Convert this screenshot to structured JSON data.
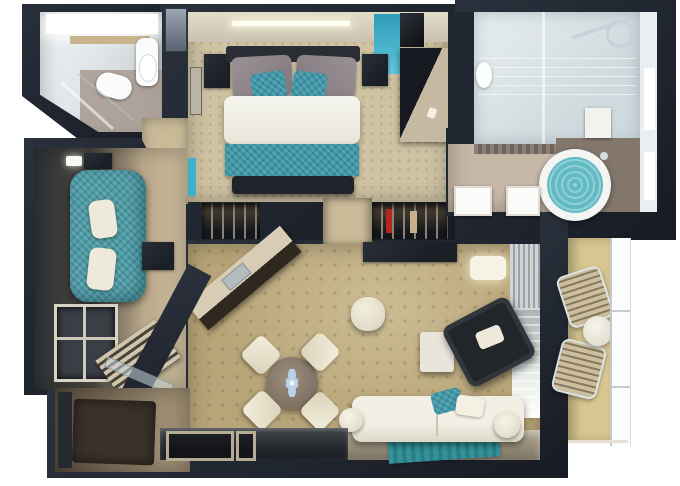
{
  "scene": {
    "type": "3d-floor-plan",
    "rooms": [
      {
        "name": "guest-bathroom",
        "features": [
          "lit-vanity",
          "wood-shelf",
          "mirror-cabinet",
          "sink",
          "toilet",
          "glass-shower-screen"
        ]
      },
      {
        "name": "bedroom",
        "features": [
          "cream-headwall-with-lightbar",
          "teal-accent-wall",
          "double-bed",
          "grey-pillows",
          "teal-pillows",
          "white-duvet",
          "teal-runner",
          "foot-bench",
          "two-nightstands",
          "wall-art",
          "dresser-unit"
        ]
      },
      {
        "name": "wardrobe-corridor",
        "features": [
          "left-wardrobe-with-clothes",
          "right-wardrobe-with-clothes",
          "doorway-carpet"
        ]
      },
      {
        "name": "master-bathroom",
        "features": [
          "walk-in-glass-shower",
          "chrome-fixtures",
          "toilet",
          "mosaic-tile-band",
          "double-sinks",
          "round-jacuzzi-teal-water",
          "white-cabinet",
          "window-wall"
        ]
      },
      {
        "name": "lounge",
        "features": [
          "ceiling-light",
          "wall-tv",
          "teal-chaise-sofa",
          "two-white-pillows",
          "dark-side-table",
          "shelving-unit",
          "slatted-bench"
        ]
      },
      {
        "name": "living-dining",
        "features": [
          "diagonal-kitchenette-counter-with-sink",
          "round-dining-table",
          "blue-flower-centerpiece",
          "four-cream-chairs",
          "white-pouf",
          "white-side-table",
          "dark-armchair-with-pillow",
          "wall-console",
          "wall-lamp",
          "vertical-blinds",
          "glass-balcony-door",
          "white-sofa-with-bolsters",
          "teal-pillow",
          "teal-striped-rug",
          "glossy-walkway"
        ]
      },
      {
        "name": "entry",
        "features": [
          "dark-brown-door-mat",
          "glossy-threshold-with-metal-frames",
          "diagonal-glass-partition"
        ]
      },
      {
        "name": "balcony",
        "features": [
          "two-slatted-loungers",
          "round-white-table",
          "glass-railing"
        ]
      }
    ]
  },
  "palette": {
    "wall": "#212731",
    "wall_dark": "#171b23",
    "wall_mid": "#2b313c",
    "floor_bedroom": "#cfc3a3",
    "floor_living": "#b7a478",
    "floor_passage": "#c9bb97",
    "floor_bath": "#c6b7a7",
    "floor_balcony": "#d8c791",
    "shower": "#dfe7ea",
    "teal_sofa": "#4d9aa4",
    "teal_accent": "#3fb0cc",
    "teal_bedding": "#3f96a8",
    "teal_water": "#62bac4",
    "teal_rug": "#2f8b93",
    "white_furn": "#eeeadb",
    "dark_furn": "#1b1f26",
    "wood": "#c9b48e",
    "wood_light": "#b5aa92",
    "mat_brown": "#3a3128",
    "glossy": "#8e8472",
    "cream_wall": "#d8d2c2",
    "window_white": "#ffffff",
    "glass": "#c7d4d9"
  }
}
